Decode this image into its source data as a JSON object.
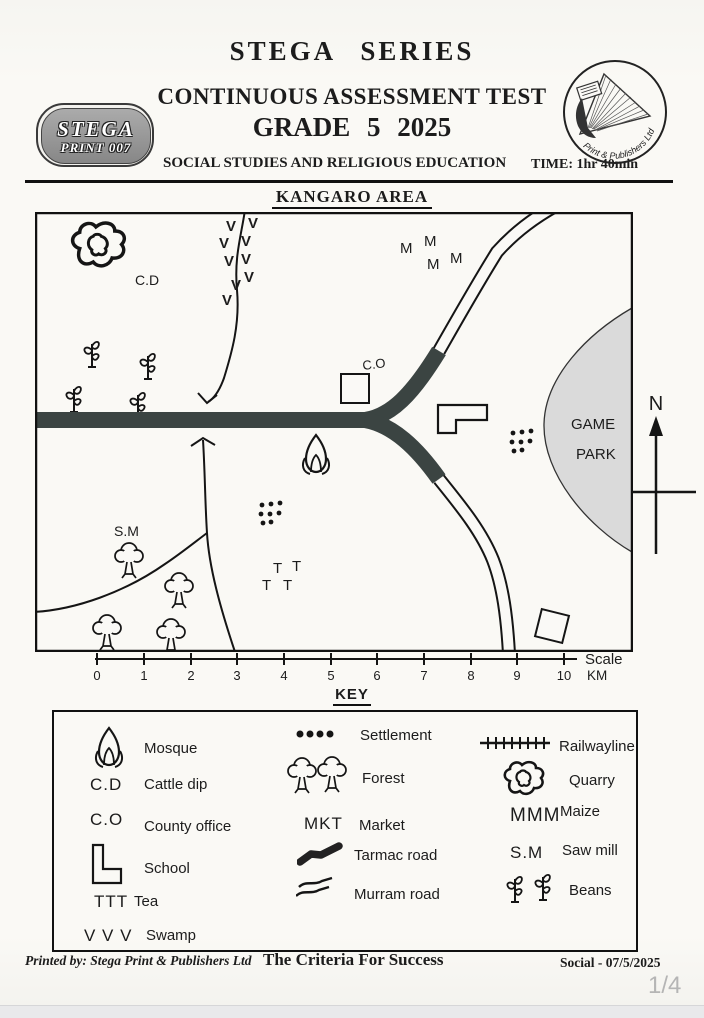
{
  "document": {
    "header": {
      "series_title": "STEGA  SERIES",
      "test_title": "CONTINUOUS ASSESSMENT TEST",
      "grade_title": "GRADE 5  2025",
      "subject": "SOCIAL STUDIES AND RELIGIOUS EDUCATION",
      "time": "TIME: 1hr 40min",
      "badge_line1": "STEGA",
      "badge_line2": "PRINT 007",
      "logo_arc_text": "Print & Publishers Ltd"
    },
    "map": {
      "title": "KANGARO AREA",
      "labels": {
        "cattle_dip": "C.D",
        "county_office": "C.O",
        "saw_mill": "S.M",
        "game_line1": "GAME",
        "game_line2": "PARK",
        "north": "N",
        "swamp": "V",
        "maize": "M",
        "tea": "T"
      },
      "scale": {
        "label": "Scale",
        "unit": "KM",
        "ticks": [
          "0",
          "1",
          "2",
          "3",
          "4",
          "5",
          "6",
          "7",
          "8",
          "9",
          "10"
        ]
      }
    },
    "key": {
      "title": "KEY",
      "col1": [
        {
          "sym": "",
          "label": "Mosque"
        },
        {
          "sym": "C.D",
          "label": "Cattle dip"
        },
        {
          "sym": "C.O",
          "label": "County office"
        },
        {
          "sym": "",
          "label": "School"
        },
        {
          "sym": "TTT",
          "label": "Tea"
        },
        {
          "sym": "V V V",
          "label": "Swamp"
        }
      ],
      "col2": [
        {
          "sym": "",
          "label": "Settlement"
        },
        {
          "sym": "",
          "label": "Forest"
        },
        {
          "sym": "MKT",
          "label": "Market"
        },
        {
          "sym": "",
          "label": "Tarmac road"
        },
        {
          "sym": "",
          "label": "Murram road"
        }
      ],
      "col3": [
        {
          "sym": "",
          "label": "Railwayline"
        },
        {
          "sym": "",
          "label": "Quarry"
        },
        {
          "sym": "MMM",
          "label": "Maize"
        },
        {
          "sym": "S.M",
          "label": "Saw mill"
        },
        {
          "sym": "",
          "label": "Beans"
        }
      ]
    },
    "footer": {
      "printed_by": "Printed by: Stega Print & Publishers Ltd",
      "motto": "The Criteria For Success",
      "doc_ref": "Social - 07/5/2025"
    },
    "viewer": {
      "page_indicator": "1/4"
    }
  }
}
